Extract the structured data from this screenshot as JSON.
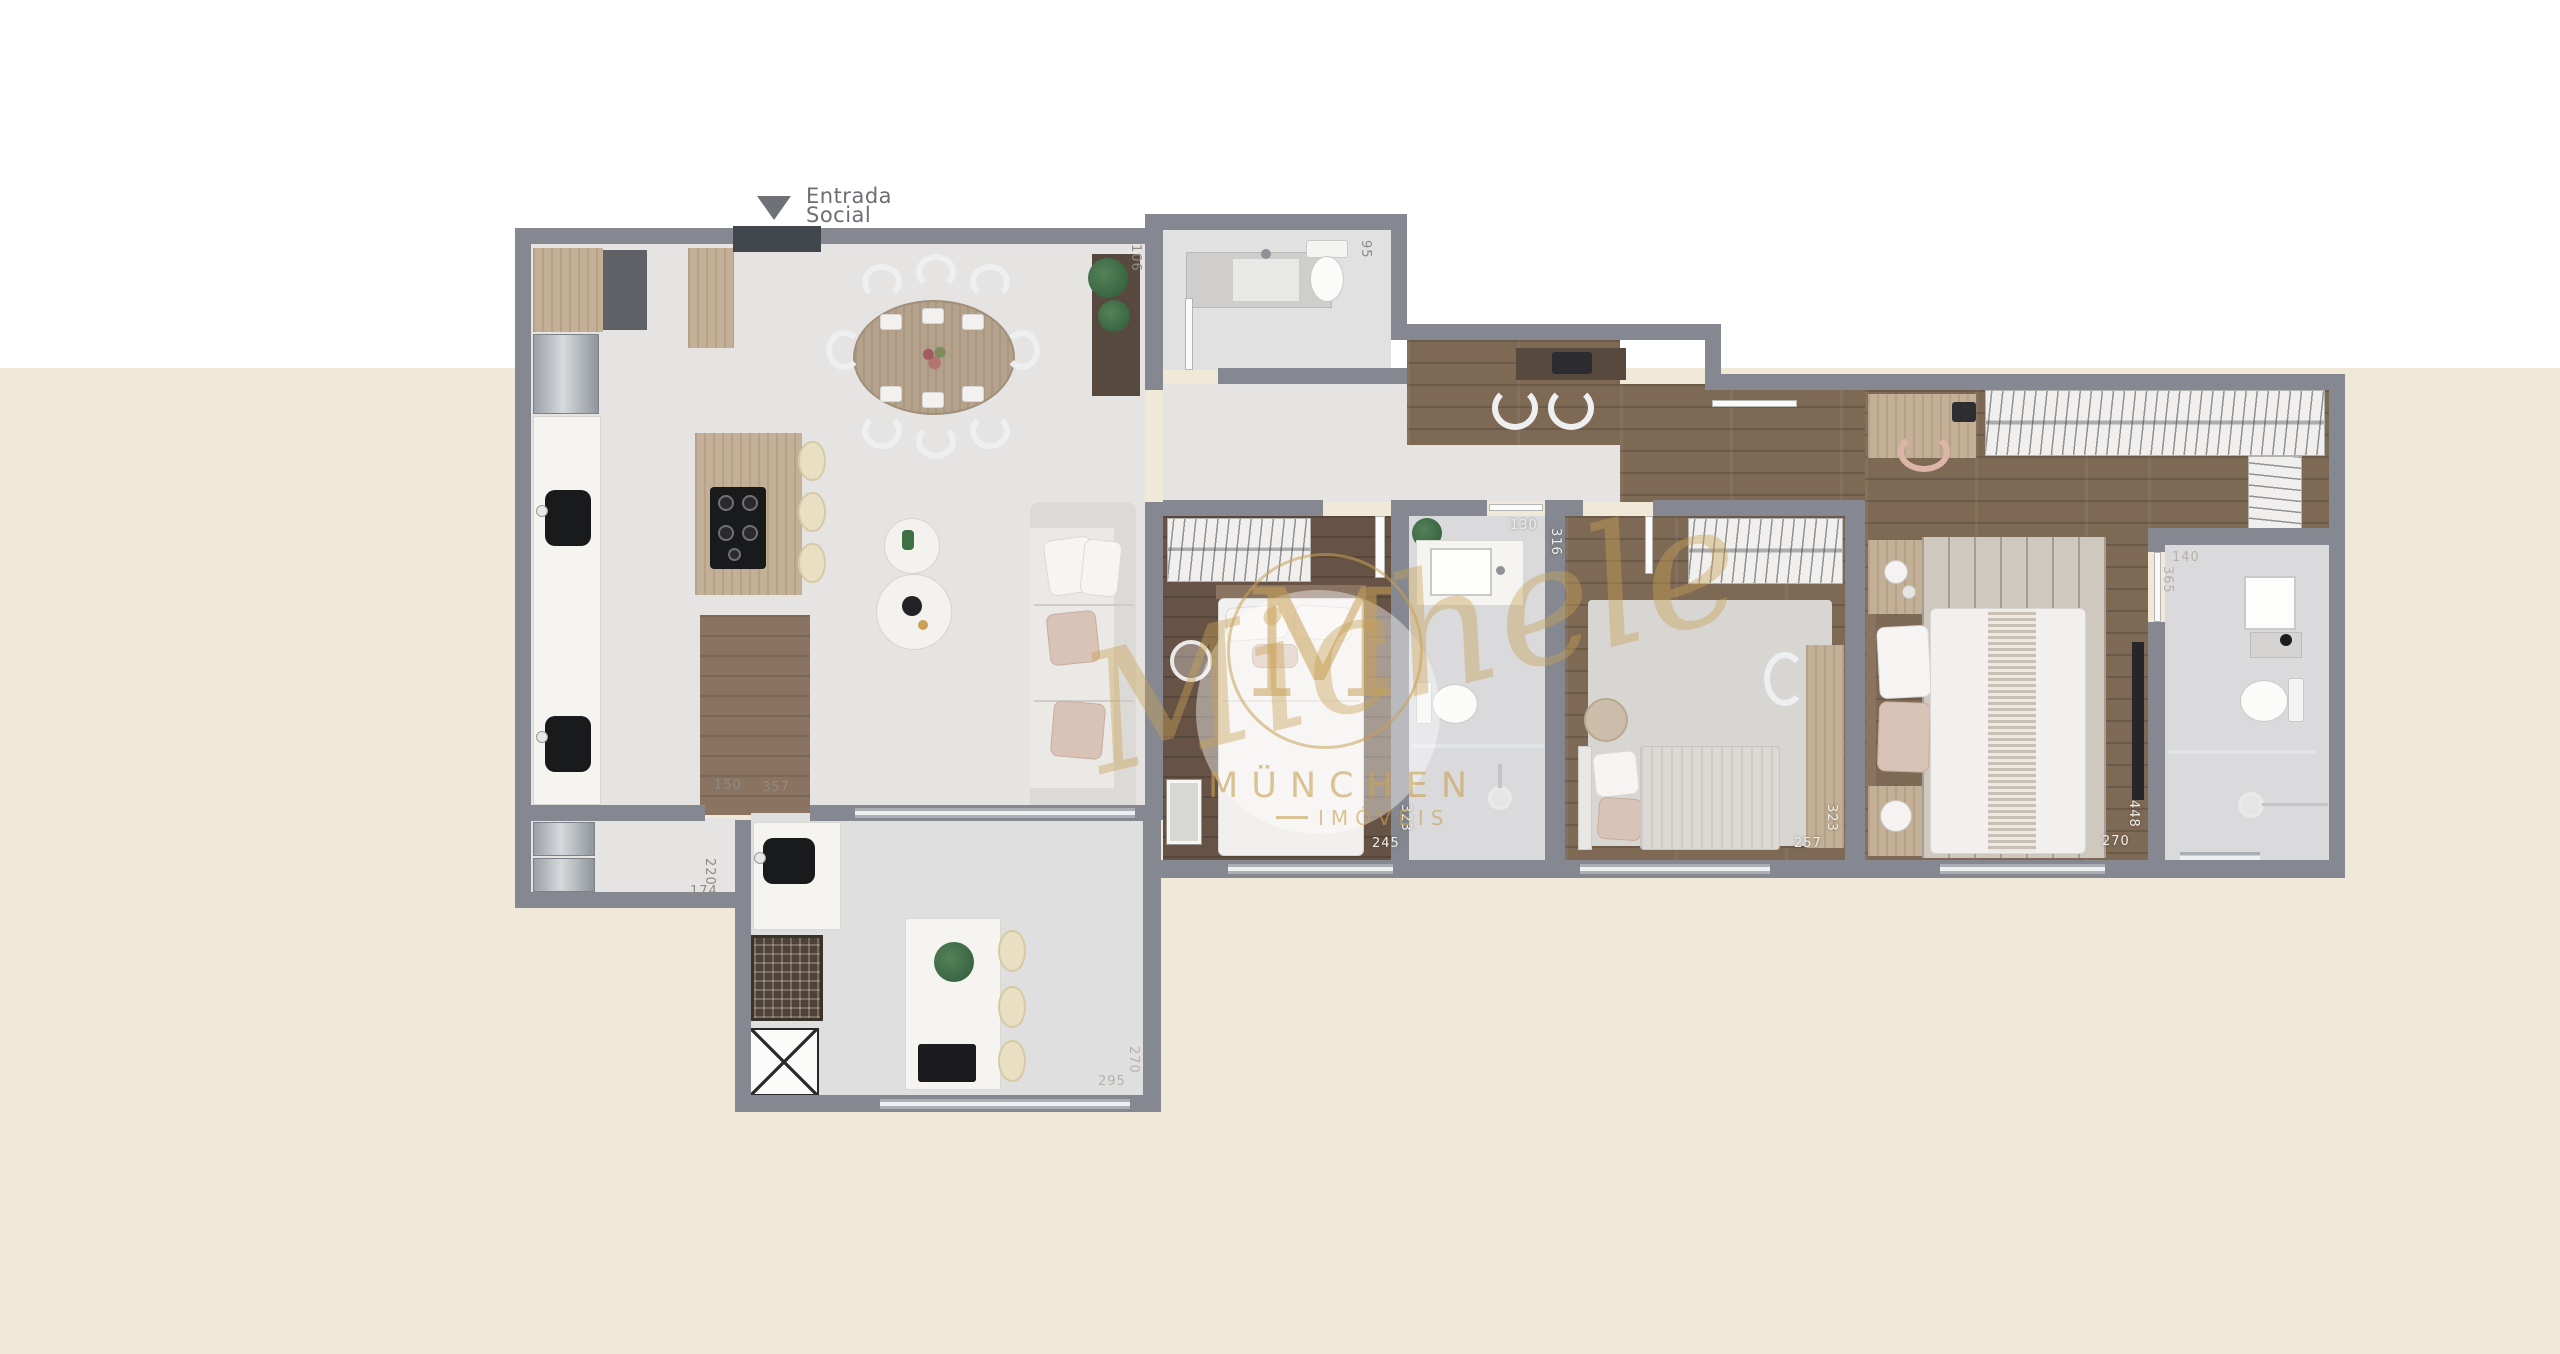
{
  "entrance": {
    "line1": "Entrada",
    "line2": "Social"
  },
  "watermark": {
    "monogram": "M",
    "script": "Michele",
    "brand": "MÜNCHEN",
    "brand_sub": "IMÓVEIS",
    "color": "#c8a156"
  },
  "dimensions": {
    "lavabo_side": "106",
    "lavabo_width": "95",
    "hall_width": "150",
    "hall_length": "357",
    "laundry_depth": "220",
    "laundry_width": "174",
    "gourmet_width": "295",
    "gourmet_depth": "270",
    "bedroom1_width": "245",
    "bedroom1_depth": "323",
    "bath2_width": "130",
    "bath2_depth": "316",
    "bedroom2_width": "257",
    "bedroom2_depth": "323",
    "master_width": "270",
    "master_depth": "448",
    "master_bath_width": "140",
    "master_bath_depth": "365"
  },
  "colors": {
    "background_lower": "#f0e9d8",
    "wall": "#858890",
    "wood_floor": "#7e6955",
    "watermark_gold": "#c8a156"
  }
}
